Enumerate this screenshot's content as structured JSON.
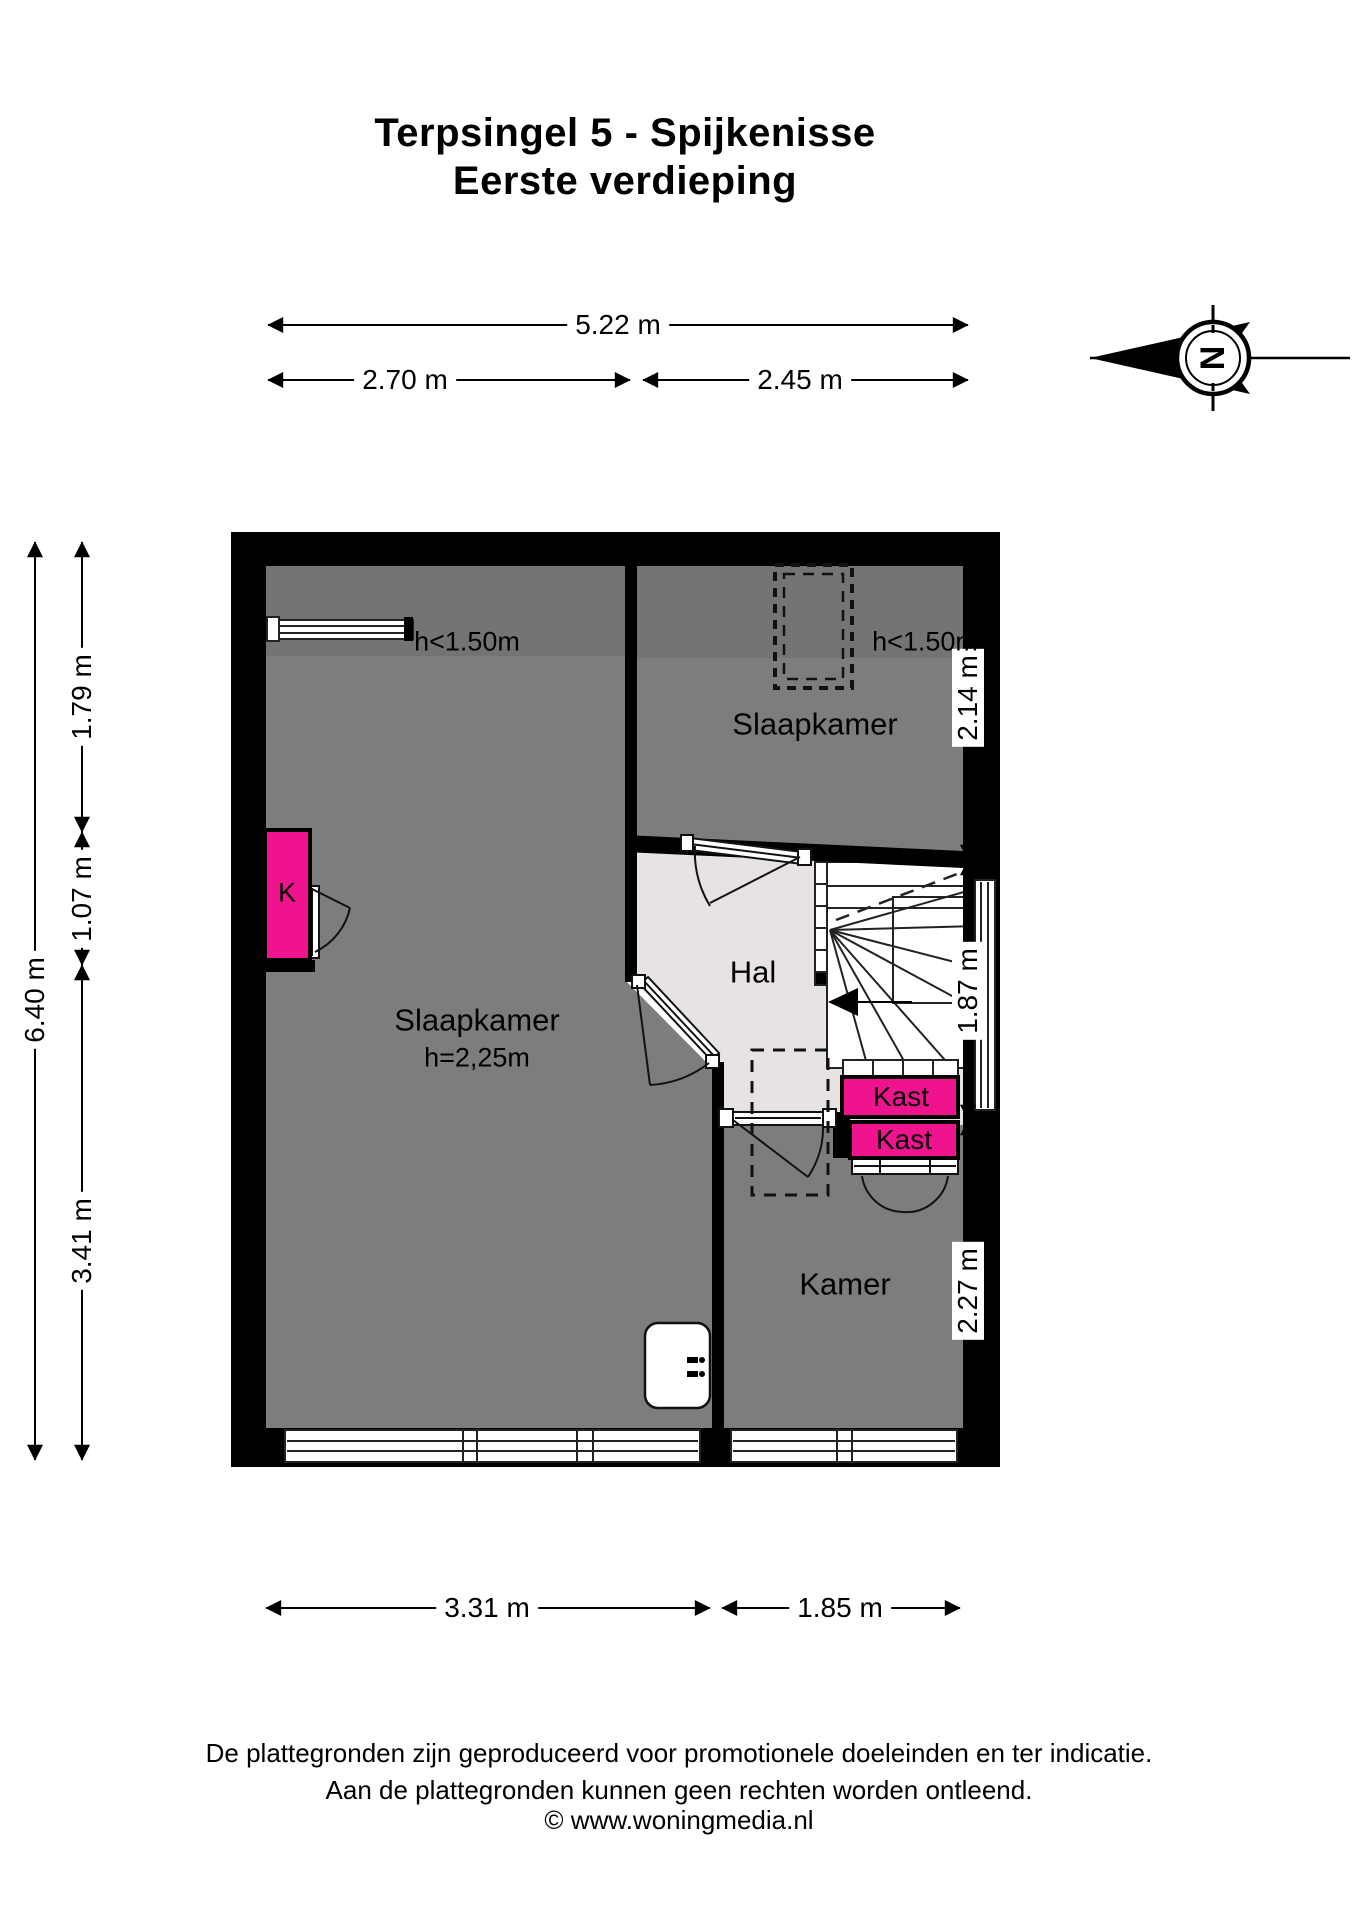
{
  "title": {
    "line1": "Terpsingel 5 - Spijkenisse",
    "line2": "Eerste verdieping"
  },
  "compass": {
    "label": "N"
  },
  "dimensions": {
    "top_total": "5.22 m",
    "top_left": "2.70 m",
    "top_right": "2.45 m",
    "left_total": "6.40 m",
    "left_segments": [
      "1.79 m",
      "1.07 m",
      "3.41 m"
    ],
    "right_segments": [
      "2.14 m",
      "1.87 m",
      "2.27 m"
    ],
    "bottom_left": "3.31 m",
    "bottom_right": "1.85 m"
  },
  "rooms": {
    "bedroom_left": {
      "name": "Slaapkamer",
      "height_note": "h=2,25m",
      "low_headroom": "h<1.50m"
    },
    "bedroom_right": {
      "name": "Slaapkamer",
      "low_headroom": "h<1.50m"
    },
    "hall": {
      "name": "Hal"
    },
    "room": {
      "name": "Kamer"
    },
    "closet_top": {
      "name": "Kast"
    },
    "closet_bottom": {
      "name": "Kast"
    },
    "closet_k": {
      "name": "K"
    }
  },
  "footer": {
    "line1": "De plattegronden zijn geproduceerd voor promotionele doeleinden en ter indicatie.",
    "line2": "Aan de plattegronden kunnen geen rechten worden ontleend.",
    "line3": "© www.woningmedia.nl"
  },
  "colors": {
    "wall": "#000000",
    "floor": "#7d7d7d",
    "floor_low_headroom": "#747474",
    "hall_floor": "#e8e3e3",
    "closet_accent": "#f0138e"
  }
}
